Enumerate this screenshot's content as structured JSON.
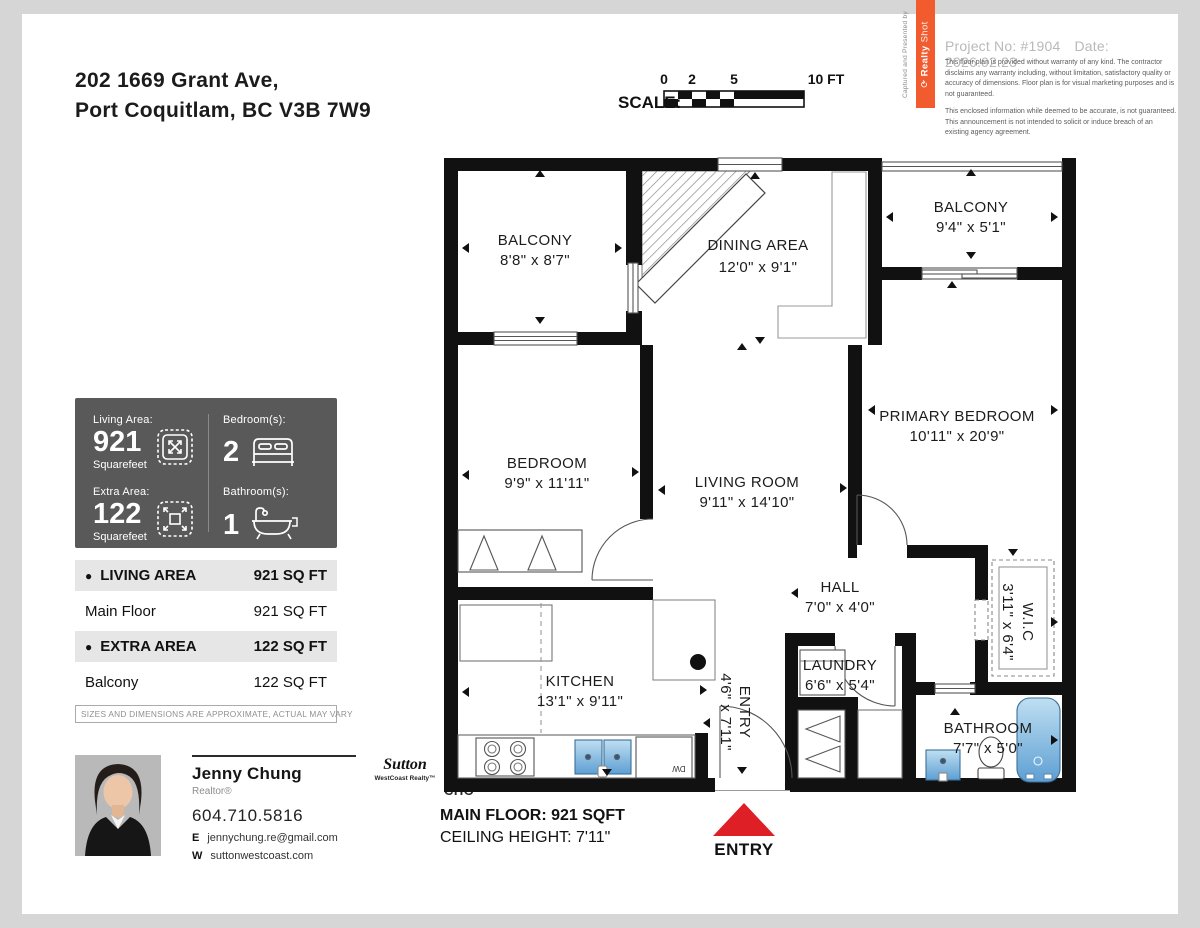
{
  "address": {
    "line1": "202 1669 Grant Ave,",
    "line2": "Port Coquitlam, BC V3B 7W9"
  },
  "scale_bar": {
    "label": "SCALE:",
    "tick0": "0",
    "tick2": "2",
    "tick5": "5",
    "tick10": "10 FT"
  },
  "ribbon": {
    "caption": "Captured and Presented by",
    "logo_glyph": "⟳",
    "brand_bold": "Realty",
    "brand_light": "Shot"
  },
  "project": {
    "number": "Project No: #1904",
    "date": "Date: 2026.02.23",
    "disclaimer1": "This floor plan is provided without warranty of any kind. The contractor disclaims any warranty including, without limitation, satisfactory quality or accuracy of dimensions. Floor plan is for visual marketing purposes and is not guaranteed.",
    "disclaimer2": "This enclosed information while deemed to be accurate, is not guaranteed. This announcement is not intended to solicit or induce breach of an existing agency agreement."
  },
  "stats": {
    "living_area_label": "Living Area:",
    "living_area_value": "921",
    "living_area_unit": "Squarefeet",
    "bedrooms_label": "Bedroom(s):",
    "bedrooms_value": "2",
    "extra_area_label": "Extra Area:",
    "extra_area_value": "122",
    "extra_area_unit": "Squarefeet",
    "bathrooms_label": "Bathroom(s):",
    "bathrooms_value": "1"
  },
  "area_table": {
    "bullet": "●",
    "living_header": "LIVING AREA",
    "living_total": "921 SQ FT",
    "living_rows": [
      {
        "name": "Main Floor",
        "value": "921 SQ FT"
      }
    ],
    "extra_header": "EXTRA AREA",
    "extra_total": "122 SQ FT",
    "extra_rows": [
      {
        "name": "Balcony",
        "value": "122 SQ FT"
      }
    ],
    "note": "SIZES AND DIMENSIONS ARE APPROXIMATE, ACTUAL MAY VARY"
  },
  "agent": {
    "name": "Jenny Chung",
    "title": "Realtor®",
    "phone": "604.710.5816",
    "email_label": "E",
    "email": "jennychung.re@gmail.com",
    "website_label": "W",
    "website": "suttonwestcoast.com",
    "brokerage_name": "Sutton",
    "brokerage_sub": "WestCoast Realty™",
    "team_top": "TED",
    "team_bottom": "CHO"
  },
  "plan": {
    "rooms": [
      {
        "name": "BALCONY",
        "dims": "8'8\" x 8'7\""
      },
      {
        "name": "DINING AREA",
        "dims": "12'0\" x 9'1\""
      },
      {
        "name": "BALCONY",
        "dims": "9'4\" x 5'1\""
      },
      {
        "name": "PRIMARY BEDROOM",
        "dims": "10'11\" x 20'9\""
      },
      {
        "name": "BEDROOM",
        "dims": "9'9\" x 11'11\""
      },
      {
        "name": "LIVING ROOM",
        "dims": "9'11\" x 14'10\""
      },
      {
        "name": "HALL",
        "dims": "7'0\" x 4'0\""
      },
      {
        "name": "W.I.C",
        "dims": "3'11\" x 6'4\""
      },
      {
        "name": "LAUNDRY",
        "dims": "6'6\" x 5'4\""
      },
      {
        "name": "KITCHEN",
        "dims": "13'1\" x 9'11\""
      },
      {
        "name": "ENTRY",
        "dims": "4'6\" x 7'11\""
      },
      {
        "name": "BATHROOM",
        "dims": "7'7\" x 5'0\""
      }
    ],
    "dw_label": "DW",
    "footer_line1": "MAIN FLOOR: 921 SQFT",
    "footer_line2": "CEILING HEIGHT: 7'11\"",
    "entry_label": "ENTRY"
  },
  "colors": {
    "accent_orange": "#F15B2D",
    "entry_red": "#DE1F26",
    "wall_black": "#111111",
    "panel_gray": "#595959",
    "fixture_blue": "#8FC2E4"
  }
}
